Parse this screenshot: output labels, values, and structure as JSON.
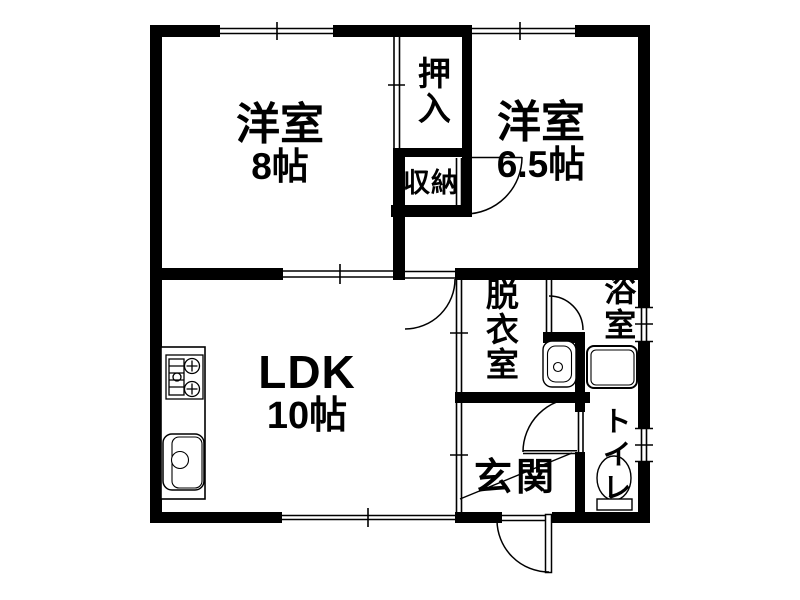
{
  "colors": {
    "wall": "#000000",
    "background": "#ffffff",
    "line": "#000000"
  },
  "rooms": {
    "western8": {
      "name": "洋室",
      "size": "8帖"
    },
    "western65": {
      "name": "洋室",
      "size": "6.5帖"
    },
    "ldk": {
      "name": "LDK",
      "size": "10帖"
    },
    "oshiire": {
      "label": "押入"
    },
    "shuno": {
      "label": "収納"
    },
    "datsuishitsu": {
      "label": "脱衣室"
    },
    "yokushitsu": {
      "label": "浴室"
    },
    "genkan": {
      "label": "玄関"
    },
    "toilet": {
      "label": "トイレ"
    }
  },
  "fixtures": {
    "stove": "gas-stove",
    "sink": "kitchen-sink",
    "washbasin": "washbasin",
    "bathtub": "bathtub",
    "toilet": "toilet-bowl"
  },
  "symbols": {
    "window": "sliding-window",
    "hinged_door": "door-swing-arc",
    "sliding_door": "sliding-door-track",
    "entry_step": "genkan-step-diagonal"
  }
}
